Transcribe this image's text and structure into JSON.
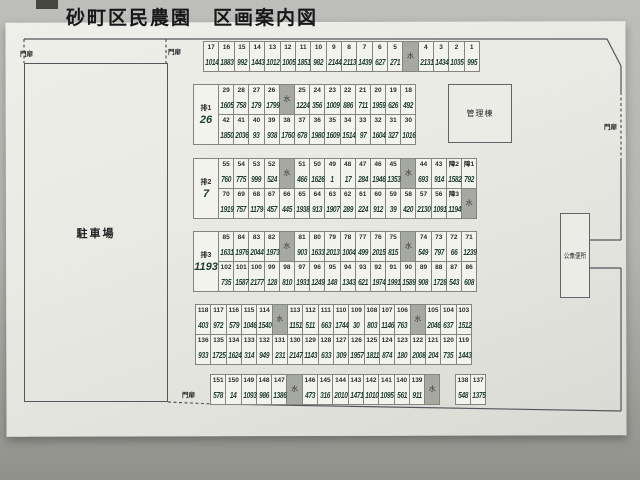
{
  "title": "砂町区民農園　区画案内図",
  "legend": {
    "water": "水",
    "gate": "門扉"
  },
  "facilities": {
    "parking": "駐車場",
    "management": "管理棟",
    "toilet": "公衆便所"
  },
  "plots": {
    "blocks": [
      {
        "id": "A",
        "rows": [
          [
            [
              "17",
              "1014"
            ],
            [
              "16",
              "1883"
            ],
            [
              "15",
              "992"
            ],
            [
              "14",
              "1443"
            ],
            [
              "13",
              "1012"
            ],
            [
              "12",
              "1005"
            ],
            [
              "11",
              "1851"
            ],
            [
              "10",
              "982"
            ],
            [
              "9",
              "2144"
            ],
            [
              "8",
              "2113"
            ],
            [
              "7",
              "1439"
            ],
            [
              "6",
              "627"
            ],
            [
              "5",
              "271"
            ],
            "W",
            [
              "4",
              "2131"
            ],
            [
              "3",
              "1434"
            ],
            [
              "2",
              "1035"
            ],
            [
              "1",
              "995"
            ]
          ]
        ]
      },
      {
        "id": "B",
        "label": "排1",
        "label_value": "26",
        "rows": [
          [
            [
              "29",
              "1605"
            ],
            [
              "28",
              "758"
            ],
            [
              "27",
              "179"
            ],
            [
              "26",
              "1799"
            ],
            "W",
            [
              "25",
              "1224"
            ],
            [
              "24",
              "356"
            ],
            [
              "23",
              "1009"
            ],
            [
              "22",
              "886"
            ],
            [
              "21",
              "711"
            ],
            [
              "20",
              "1959"
            ],
            [
              "19",
              "626"
            ],
            [
              "18",
              "492"
            ]
          ],
          [
            [
              "42",
              "1850"
            ],
            [
              "41",
              "2036"
            ],
            [
              "40",
              "93"
            ],
            [
              "39",
              "938"
            ],
            [
              "38",
              "1760"
            ],
            [
              "37",
              "678"
            ],
            [
              "36",
              "1980"
            ],
            [
              "35",
              "1609"
            ],
            [
              "34",
              "1514"
            ],
            [
              "33",
              "97"
            ],
            [
              "32",
              "1604"
            ],
            [
              "31",
              "327"
            ],
            [
              "30",
              "1016"
            ]
          ]
        ]
      },
      {
        "id": "C",
        "label": "排2",
        "label_value": "7",
        "rows": [
          [
            [
              "55",
              "760"
            ],
            [
              "54",
              "775"
            ],
            [
              "53",
              "999"
            ],
            [
              "52",
              "524"
            ],
            "W",
            [
              "51",
              "466"
            ],
            [
              "50",
              "1626"
            ],
            [
              "49",
              "1"
            ],
            [
              "48",
              "17"
            ],
            [
              "47",
              "284"
            ],
            [
              "46",
              "1946"
            ],
            [
              "45",
              "1353"
            ],
            "W",
            [
              "44",
              "693"
            ],
            [
              "43",
              "914"
            ],
            [
              "障2",
              "1582"
            ],
            [
              "障1",
              "792"
            ]
          ],
          [
            [
              "70",
              "1919"
            ],
            [
              "69",
              "757"
            ],
            [
              "68",
              "1179"
            ],
            [
              "67",
              "457"
            ],
            [
              "66",
              "445"
            ],
            [
              "65",
              "1938"
            ],
            [
              "64",
              "913"
            ],
            [
              "63",
              "1907"
            ],
            [
              "62",
              "289"
            ],
            [
              "61",
              "224"
            ],
            [
              "60",
              "912"
            ],
            [
              "59",
              "39"
            ],
            [
              "58",
              "420"
            ],
            [
              "57",
              "2130"
            ],
            [
              "56",
              "1091"
            ],
            [
              "障3",
              "1194"
            ],
            "W"
          ]
        ]
      },
      {
        "id": "D",
        "label": "排3",
        "label_value": "1193",
        "rows": [
          [
            [
              "85",
              "1631"
            ],
            [
              "84",
              "1976"
            ],
            [
              "83",
              "2044"
            ],
            [
              "82",
              "1973"
            ],
            "W",
            [
              "81",
              "903"
            ],
            [
              "80",
              "1633"
            ],
            [
              "79",
              "2013"
            ],
            [
              "78",
              "1004"
            ],
            [
              "77",
              "499"
            ],
            [
              "76",
              "2015"
            ],
            [
              "75",
              "815"
            ],
            "W",
            [
              "74",
              "549"
            ],
            [
              "73",
              "797"
            ],
            [
              "72",
              "66"
            ],
            [
              "71",
              "1239"
            ]
          ],
          [
            [
              "102",
              "735"
            ],
            [
              "101",
              "1587"
            ],
            [
              "100",
              "2177"
            ],
            [
              "99",
              "128"
            ],
            [
              "98",
              "810"
            ],
            [
              "97",
              "1931"
            ],
            [
              "96",
              "1249"
            ],
            [
              "95",
              "148"
            ],
            [
              "94",
              "1343"
            ],
            [
              "93",
              "621"
            ],
            [
              "92",
              "1974"
            ],
            [
              "91",
              "1991"
            ],
            [
              "90",
              "1589"
            ],
            [
              "89",
              "908"
            ],
            [
              "88",
              "1728"
            ],
            [
              "87",
              "543"
            ],
            [
              "86",
              "608"
            ]
          ]
        ]
      },
      {
        "id": "E",
        "rows": [
          [
            [
              "118",
              "403"
            ],
            [
              "117",
              "972"
            ],
            [
              "116",
              "579"
            ],
            [
              "115",
              "1046"
            ],
            [
              "114",
              "1540"
            ],
            "W",
            [
              "113",
              "1151"
            ],
            [
              "112",
              "511"
            ],
            [
              "111",
              "663"
            ],
            [
              "110",
              "1744"
            ],
            [
              "109",
              "30"
            ],
            [
              "108",
              "803"
            ],
            [
              "107",
              "1146"
            ],
            [
              "106",
              "763"
            ],
            "W",
            [
              "105",
              "2046"
            ],
            [
              "104",
              "637"
            ],
            [
              "103",
              "1512"
            ]
          ],
          [
            [
              "136",
              "933"
            ],
            [
              "135",
              "1725"
            ],
            [
              "134",
              "1624"
            ],
            [
              "133",
              "314"
            ],
            [
              "132",
              "949"
            ],
            [
              "131",
              "231"
            ],
            [
              "130",
              "2147"
            ],
            [
              "129",
              "1143"
            ],
            [
              "128",
              "633"
            ],
            [
              "127",
              "309"
            ],
            [
              "126",
              "1957"
            ],
            [
              "125",
              "1811"
            ],
            [
              "124",
              "874"
            ],
            [
              "123",
              "180"
            ],
            [
              "122",
              "2008"
            ],
            [
              "121",
              "204"
            ],
            [
              "120",
              "735"
            ],
            [
              "119",
              "1443"
            ]
          ]
        ]
      },
      {
        "id": "F",
        "rows": [
          [
            [
              "151",
              "578"
            ],
            [
              "150",
              "14"
            ],
            [
              "149",
              "1093"
            ],
            [
              "148",
              "986"
            ],
            [
              "147",
              "1386"
            ],
            "W",
            [
              "146",
              "473"
            ],
            [
              "145",
              "316"
            ],
            [
              "144",
              "2010"
            ],
            [
              "143",
              "1471"
            ],
            [
              "142",
              "1010"
            ],
            [
              "141",
              "1095"
            ],
            [
              "140",
              "561"
            ],
            [
              "139",
              "911"
            ],
            "W",
            "G",
            [
              "138",
              "548"
            ],
            [
              "137",
              "1375"
            ]
          ]
        ]
      }
    ]
  }
}
